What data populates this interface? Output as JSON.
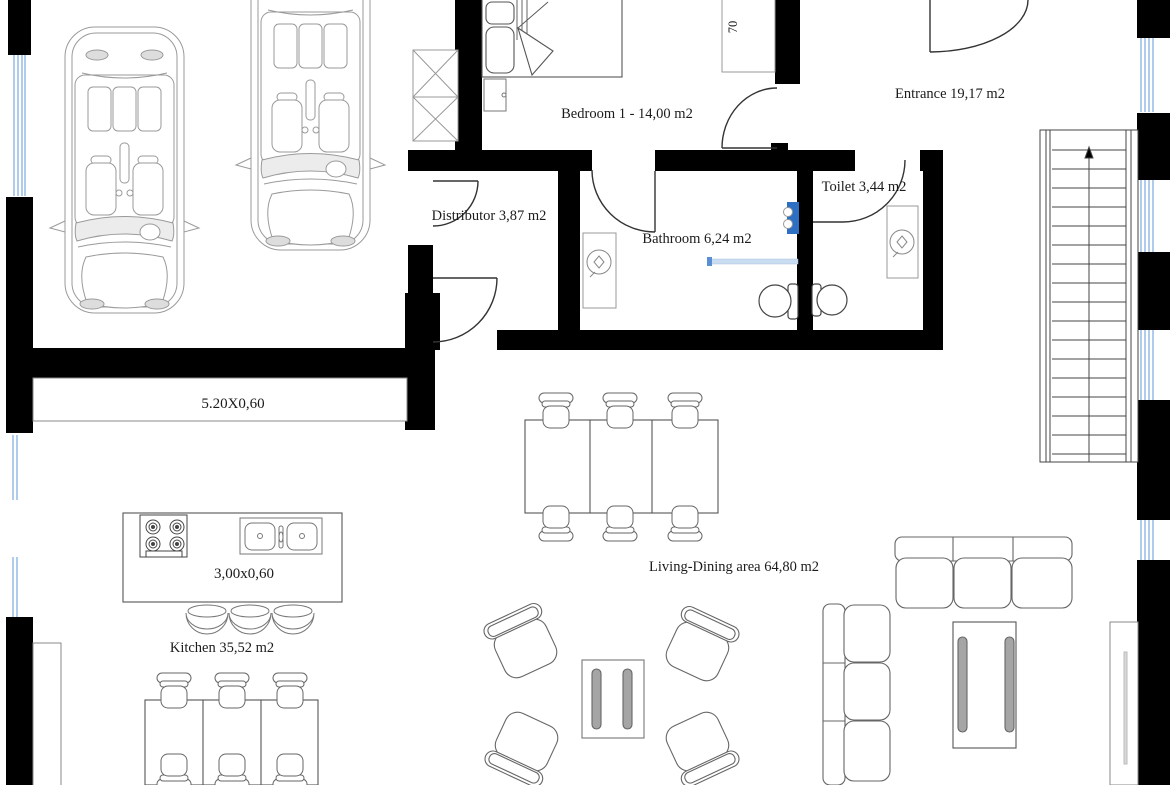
{
  "plan": {
    "rooms": {
      "bedroom": {
        "label": "Bedroom 1 - 14,00 m2"
      },
      "entrance": {
        "label": "Entrance 19,17 m2"
      },
      "distributor": {
        "label": "Distributor 3,87 m2"
      },
      "bathroom": {
        "label": "Bathroom 6,24 m2"
      },
      "toilet": {
        "label": "Toilet 3,44 m2"
      },
      "kitchen": {
        "label": "Kitchen 35,52 m2"
      },
      "living_dining": {
        "label": "Living-Dining area 64,80 m2"
      }
    },
    "dimensions": {
      "garage_sideboard": "5.20X0,60",
      "kitchen_island": "3,00x0,60",
      "entrance_closet": "70"
    },
    "colors": {
      "wall": "#000000",
      "window_blue": "#8fb7e3",
      "fixture_blue": "#2d6fc2",
      "divider_blue": "#c9dcf0",
      "furniture_outline": "#555555",
      "car_outline": "#999999"
    }
  }
}
